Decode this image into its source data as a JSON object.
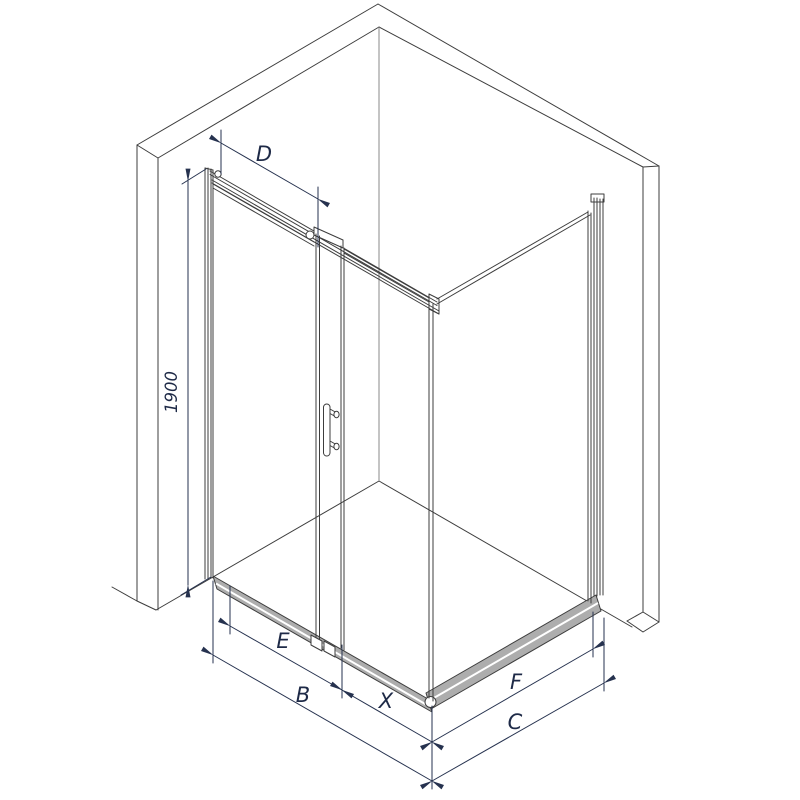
{
  "drawing": {
    "labels": {
      "top_rail_width": "D",
      "height_left": "1900",
      "front_opening": "E",
      "front_total": "B",
      "front_fixed": "X",
      "side_glass": "F",
      "side_total": "C"
    },
    "colors": {
      "outline": "#3d3d3d",
      "dimension": "#1e2a47",
      "tray_rail": "#adadad",
      "background": "#ffffff"
    }
  }
}
